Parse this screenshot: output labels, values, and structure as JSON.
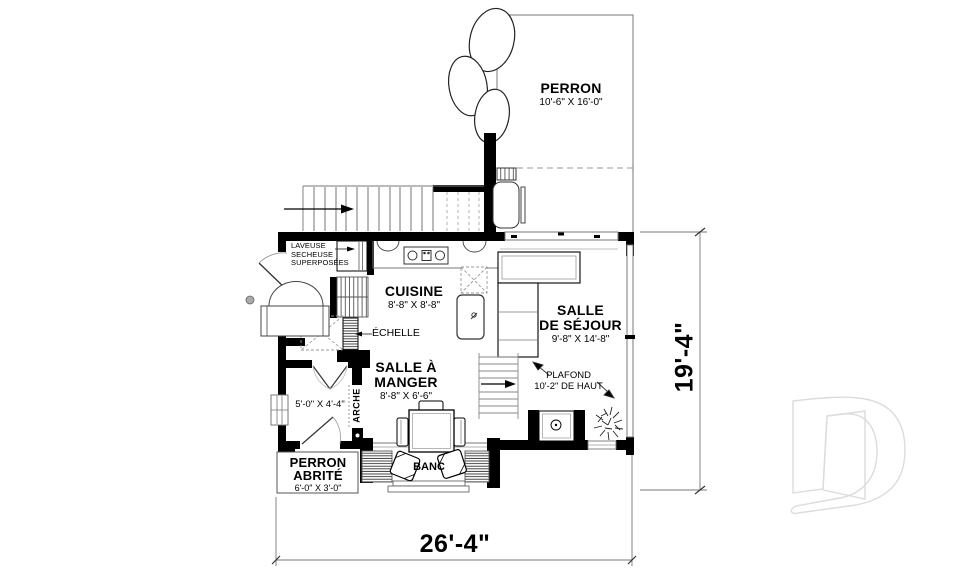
{
  "plan": {
    "rooms": {
      "perron": {
        "name": "PERRON",
        "dims": "10'-6\" X 16'-0\""
      },
      "cuisine": {
        "name": "CUISINE",
        "dims": "8'-8\" X 8'-8\""
      },
      "salle_de_sejour": {
        "name1": "SALLE",
        "name2": "DE SÉJOUR",
        "dims": "9'-8\" X 14'-8\""
      },
      "salle_a_manger": {
        "name1": "SALLE À",
        "name2": "MANGER",
        "dims": "8'-8\" X 6'-6\""
      },
      "vestibule": {
        "dims": "5'-0\" X 4'-4\""
      },
      "perron_abrite": {
        "name1": "PERRON",
        "name2": "ABRITÉ",
        "dims": "6'-0\" X 3'-0\""
      }
    },
    "annotations": {
      "laundry_line1": "LAVEUSE",
      "laundry_line2": "SECHEUSE",
      "laundry_line3": "SUPERPOSÉES",
      "echelle": "ÉCHELLE",
      "arche": "ARCHE",
      "banc": "BANC",
      "plafond_line1": "PLAFOND",
      "plafond_line2": "10'-2\" DE HAUT"
    },
    "dimensions": {
      "overall_width": "26'-4\"",
      "overall_depth": "19'-4\""
    },
    "colors": {
      "wall": "#000000",
      "thin_line": "#777777",
      "watermark": "#dcdcdc"
    }
  }
}
